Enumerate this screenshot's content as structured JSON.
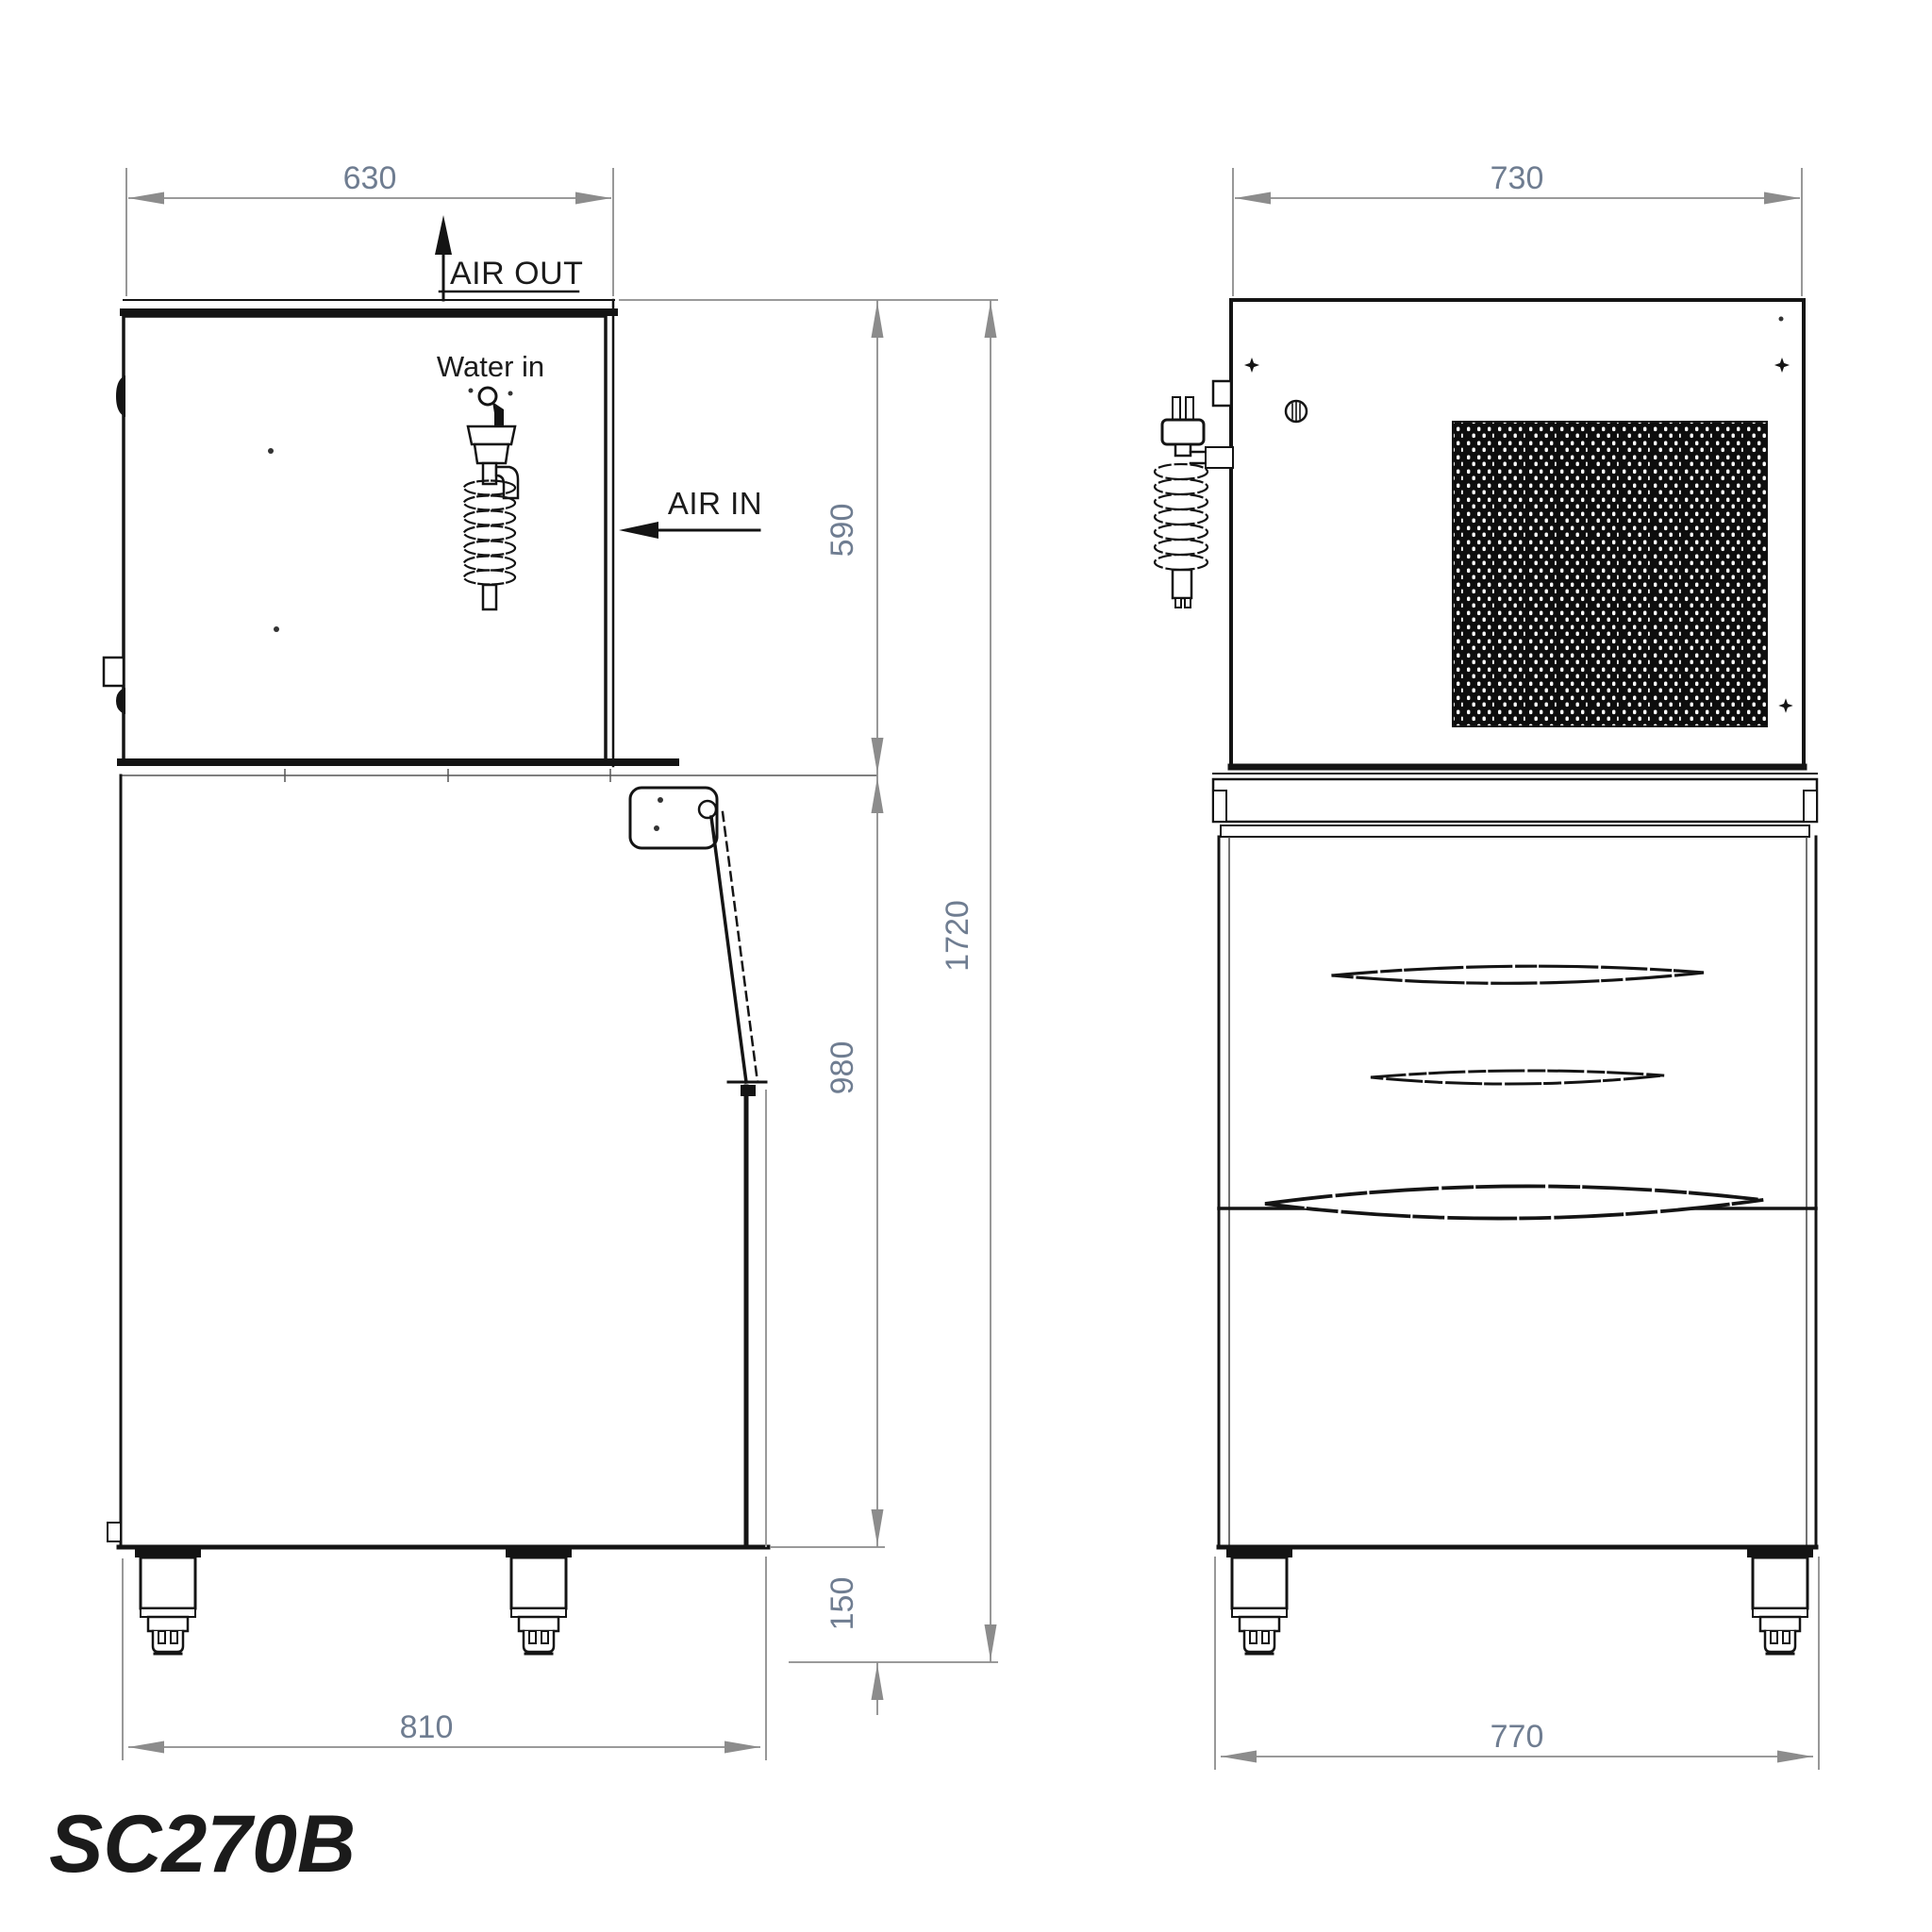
{
  "drawing": {
    "model": "SC270B",
    "views": {
      "side": {
        "title": "side-elevation",
        "labels": {
          "air_out": "AIR OUT",
          "water_in": "Water in",
          "air_in": "AIR IN"
        },
        "dims": {
          "top_width": "630",
          "top_height": "590",
          "bin_height": "980",
          "leg_height": "150",
          "overall_height": "1720",
          "base_depth": "810"
        }
      },
      "front": {
        "title": "rear-elevation",
        "dims": {
          "top_width": "730",
          "base_width": "770"
        }
      }
    },
    "colors": {
      "line": "#141414",
      "dim_line": "#8c8c8c",
      "dim_text": "#6f7d91",
      "label_text": "#1b1b1b"
    }
  }
}
